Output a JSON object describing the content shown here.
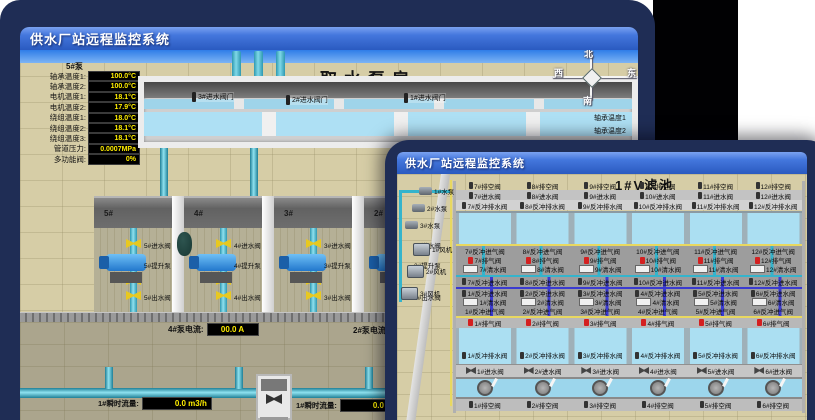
{
  "background_window": {
    "title": "供水厂站远程监控系统",
    "scene_title": "取水泵房",
    "sensor_panel": {
      "header": "5#泵",
      "rows": [
        {
          "label": "轴承温度1:",
          "value": "100.0°C"
        },
        {
          "label": "轴承温度2:",
          "value": "100.0°C"
        },
        {
          "label": "电机温度1:",
          "value": "18.1°C"
        },
        {
          "label": "电机温度2:",
          "value": "17.9°C"
        },
        {
          "label": "绕组温度1:",
          "value": "18.0°C"
        },
        {
          "label": "绕组温度2:",
          "value": "18.1°C"
        },
        {
          "label": "绕组温度3:",
          "value": "18.1°C"
        },
        {
          "label": "管道压力:",
          "value": "0.0007MPa"
        },
        {
          "label": "多功能阀:",
          "value": "0%"
        }
      ]
    },
    "inlet_gate_valves": [
      "3#进水阀门",
      "2#进水阀门",
      "1#进水阀门"
    ],
    "compass": {
      "north": "北",
      "west": "西",
      "south": "南",
      "east": "东"
    },
    "right_panel_partial_labels": [
      "轴承温度1",
      "轴承温度2"
    ],
    "pump_bays": [
      {
        "id": "5#",
        "inlet_valve": "5#进水阀",
        "pump": "5#提升泵",
        "outlet_valve": "5#出水阀",
        "has_tank": false
      },
      {
        "id": "4#",
        "inlet_valve": "4#进水阀",
        "pump": "4#提升泵",
        "outlet_valve": "4#出水阀",
        "has_tank": true
      },
      {
        "id": "3#",
        "inlet_valve": "3#进水阀",
        "pump": "3#提升泵",
        "outlet_valve": "3#出水阀",
        "has_tank": false
      },
      {
        "id": "2#",
        "inlet_valve": "2#进水阀",
        "pump": "2#提升泵",
        "outlet_valve": "2#出水阀",
        "has_tank": false
      }
    ],
    "current_readouts": [
      {
        "label": "4#泵电流:",
        "value": "00.0 A"
      },
      {
        "label": "2#泵电流:",
        "value": ""
      }
    ],
    "flow_readouts": [
      {
        "label": "1#瞬时流量:",
        "value": "0.0 m3/h"
      },
      {
        "label": "1#瞬时流量:",
        "value": "0.0 m3/h"
      }
    ]
  },
  "foreground_window": {
    "title": "供水厂站远程监控系统",
    "scene_title": "1#V滤池",
    "pumps": [
      "1#水泵",
      "2#水泵",
      "3#水泵"
    ],
    "blowers": [
      "1#风机",
      "2#风机",
      "3#风机"
    ],
    "upper_cells": {
      "drain_valves": [
        "7#排空阀",
        "8#排空阀",
        "9#排空阀",
        "10#排空阀",
        "11#排空阀",
        "12#排空阀"
      ],
      "inlet_valves": [
        "7#进水阀",
        "8#进水阀",
        "9#进水阀",
        "10#进水阀",
        "11#进水阀",
        "12#进水阀"
      ],
      "backwash_drain_valves": [
        "7#反冲排水阀",
        "8#反冲排水阀",
        "9#反冲排水阀",
        "10#反冲排水阀",
        "11#反冲排水阀",
        "12#反冲排水阀"
      ],
      "backwash_air_valves": [
        "7#反冲进气阀",
        "8#反冲进气阀",
        "9#反冲进气阀",
        "10#反冲进气阀",
        "11#反冲进气阀",
        "12#反冲进气阀"
      ],
      "exhaust_valves": [
        "7#排气阀",
        "8#排气阀",
        "9#排气阀",
        "10#排气阀",
        "11#排气阀",
        "12#排气阀"
      ],
      "clean_water_valves": [
        "7#清水阀",
        "8#清水阀",
        "9#清水阀",
        "10#清水阀",
        "11#清水阀",
        "12#清水阀"
      ],
      "backwash_water_valves": [
        "7#反冲进水阀",
        "8#反冲进水阀",
        "9#反冲进水阀",
        "10#反冲进水阀",
        "11#反冲进水阀",
        "12#反冲进水阀"
      ]
    },
    "lower_cells": {
      "backwash_water_valves": [
        "1#反冲进水阀",
        "2#反冲进水阀",
        "3#反冲进水阀",
        "4#反冲进水阀",
        "5#反冲进水阀",
        "6#反冲进水阀"
      ],
      "clean_water_valves": [
        "1#清水阀",
        "2#清水阀",
        "3#清水阀",
        "4#清水阀",
        "5#清水阀",
        "6#清水阀"
      ],
      "backwash_air_valves": [
        "1#反冲进气阀",
        "2#反冲进气阀",
        "3#反冲进气阀",
        "4#反冲进气阀",
        "5#反冲进气阀",
        "6#反冲进气阀"
      ],
      "exhaust_valves": [
        "1#排气阀",
        "2#排气阀",
        "3#排气阀",
        "4#排气阀",
        "5#排气阀",
        "6#排气阀"
      ],
      "backwash_drain_valves": [
        "1#反冲排水阀",
        "2#反冲排水阀",
        "3#反冲排水阀",
        "4#反冲排水阀",
        "5#反冲排水阀",
        "6#反冲排水阀"
      ],
      "inlet_valves": [
        "1#进水阀",
        "2#进水阀",
        "3#进水阀",
        "4#进水阀",
        "5#进水阀",
        "6#进水阀"
      ],
      "drain_valves": [
        "1#排空阀",
        "2#排空阀",
        "3#排空阀",
        "4#排空阀",
        "5#排空阀",
        "6#排空阀"
      ]
    }
  },
  "colors": {
    "backdrop_navy": "#1f2d55",
    "titlebar_blue": "#4477dd",
    "floor_tan": "#d6cda6",
    "value_text_yellow": "#ffee00",
    "alarm_red": "#d42020",
    "pipe_cyan": "#35b4cc",
    "pipe_blue": "#3b3bd0",
    "line_yellow": "#e8d860",
    "water_blue": "#abdff2"
  }
}
